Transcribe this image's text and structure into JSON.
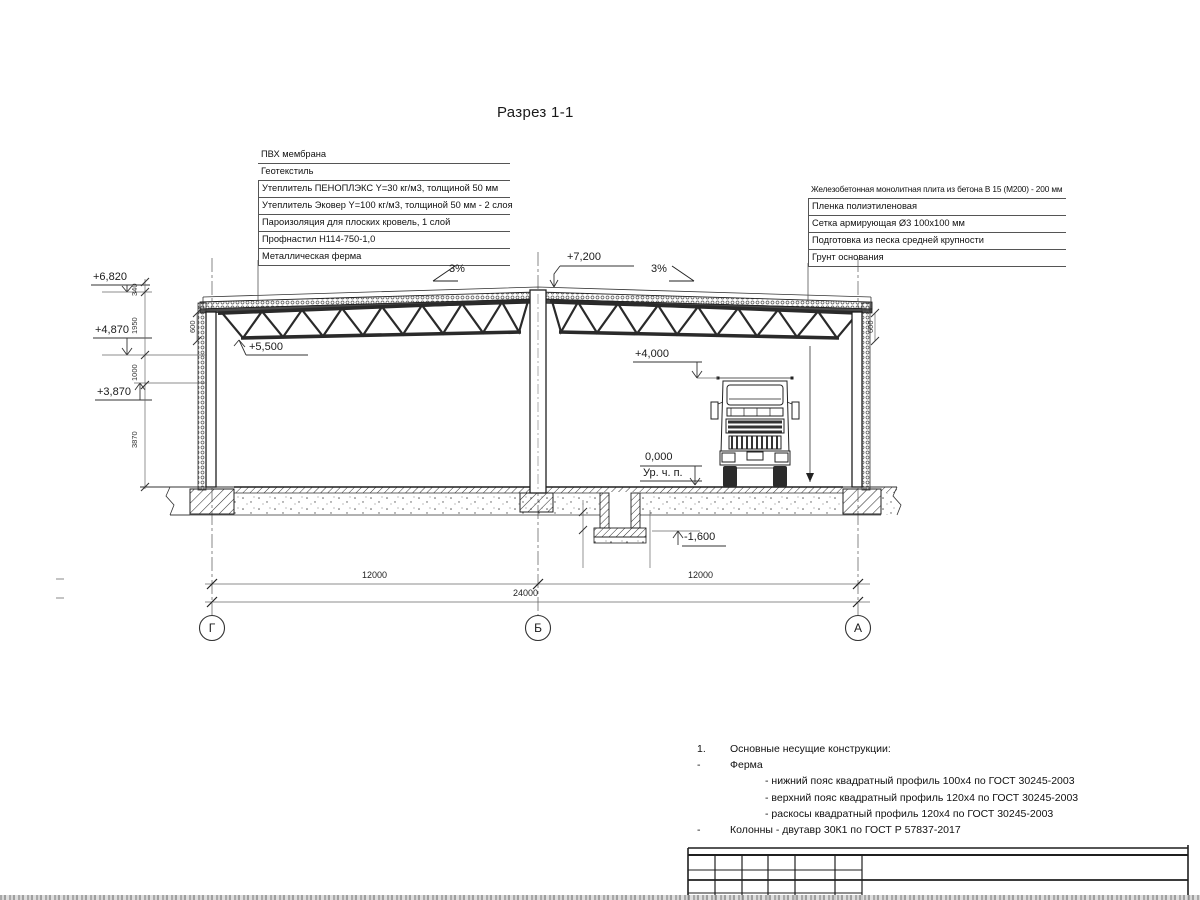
{
  "title": "Разрез 1-1",
  "roof_callouts": {
    "rows": [
      "ПВХ мембрана",
      "Геотекстиль",
      "Утеплитель ПЕНОПЛЭКС Y=30 кг/м3, толщиной 50 мм",
      "Утеплитель Эковер Y=100 кг/м3, толщиной 50 мм - 2 слоя",
      "Пароизоляция для плоских кровель, 1 слой",
      "Профнастил Н114-750-1,0",
      "Металлическая ферма"
    ]
  },
  "floor_callouts": {
    "rows": [
      "Железобетонная монолитная плита из бетона В 15 (М200) - 200 мм",
      "Пленка полиэтиленовая",
      "Сетка армирующая Ø3 100x100 мм",
      "Подготовка из песка средней крупности",
      "Грунт основания"
    ]
  },
  "levels": {
    "ridge": "+7,200",
    "eaves": "+6,820",
    "level_4870": "+4,870",
    "level_3870": "+3,870",
    "truss_bottom": "+5,500",
    "clearance": "+4,000",
    "floor": "0,000",
    "floor_note": "Ур. ч. п.",
    "pit": "-1,600"
  },
  "slopes": {
    "left": "3%",
    "right": "3%"
  },
  "dims": {
    "vertical": [
      "340",
      "1950",
      "1000",
      "3870"
    ],
    "truss_depth_left": "600",
    "truss_depth_right": "600",
    "bay_left": "12000",
    "bay_right": "12000",
    "total": "24000"
  },
  "axes": {
    "left": "Г",
    "middle": "Б",
    "right": "А"
  },
  "notes": {
    "items": [
      {
        "marker": "1.",
        "text": "Основные несущие конструкции:"
      },
      {
        "marker": "-",
        "text": "Ферма"
      },
      {
        "marker": "",
        "text": "- нижний пояс квадратный профиль 100х4 по ГОСТ 30245-2003"
      },
      {
        "marker": "",
        "text": "- верхний пояс квадратный профиль 120х4 по ГОСТ 30245-2003"
      },
      {
        "marker": "",
        "text": "- раскосы квадратный профиль 120х4 по ГОСТ 30245-2003"
      },
      {
        "marker": "-",
        "text": "Колонны - двутавр 30К1 по ГОСТ Р 57837-2017"
      }
    ]
  },
  "colors": {
    "ink": "#1f1f1f",
    "dim_line": "#666666",
    "background": "#ffffff"
  }
}
